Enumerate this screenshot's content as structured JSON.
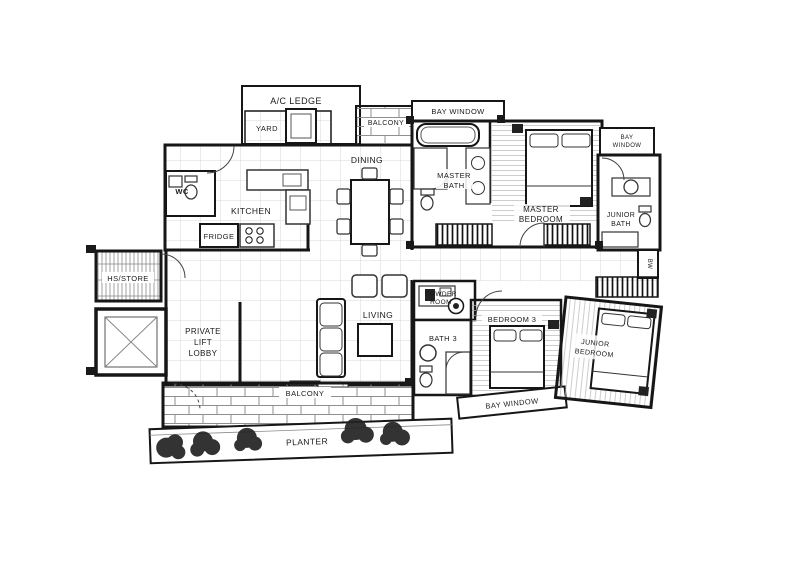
{
  "rooms": {
    "ac_ledge": {
      "label": "A/C LEDGE"
    },
    "yard": {
      "label": "YARD"
    },
    "balcony_top": {
      "label": "BALCONY"
    },
    "wc": {
      "label": "WC"
    },
    "kitchen": {
      "label": "KITCHEN"
    },
    "fridge": {
      "label": "FRIDGE"
    },
    "dining": {
      "label": "DINING"
    },
    "hs_store": {
      "label": "HS/STORE"
    },
    "lift_lobby": {
      "lines": [
        "PRIVATE",
        "LIFT",
        "LOBBY"
      ]
    },
    "living": {
      "label": "LIVING"
    },
    "master_bay_window m": {
      "label": "BAY WINDOW"
    },
    "master_bay_window": {
      "label": "BAY WINDOW"
    },
    "master_bath": {
      "lines": [
        "MASTER",
        "BATH"
      ]
    },
    "master_bedroom": {
      "lines": [
        "MASTER",
        "BEDROOM"
      ]
    },
    "junior_bay_window": {
      "lines": [
        "BAY",
        "WINDOW"
      ]
    },
    "junior_bath": {
      "lines": [
        "JUNIOR",
        "BATH"
      ]
    },
    "bw": {
      "label": "BW"
    },
    "junior_bedroom": {
      "lines": [
        "JUNIOR",
        "BEDROOM"
      ]
    },
    "powder_room": {
      "lines": [
        "POWDER",
        "ROOM"
      ]
    },
    "bath3": {
      "label": "BATH 3"
    },
    "bedroom3": {
      "label": "BEDROOM 3"
    },
    "bedroom3_bay_window": {
      "label": "BAY WINDOW"
    },
    "balcony_bottom": {
      "label": "BALCONY"
    },
    "planter": {
      "label": "PLANTER"
    }
  },
  "colors": {
    "line": "#1a1a1a",
    "grid": "#cdcdcd",
    "hatch": "#111111"
  }
}
